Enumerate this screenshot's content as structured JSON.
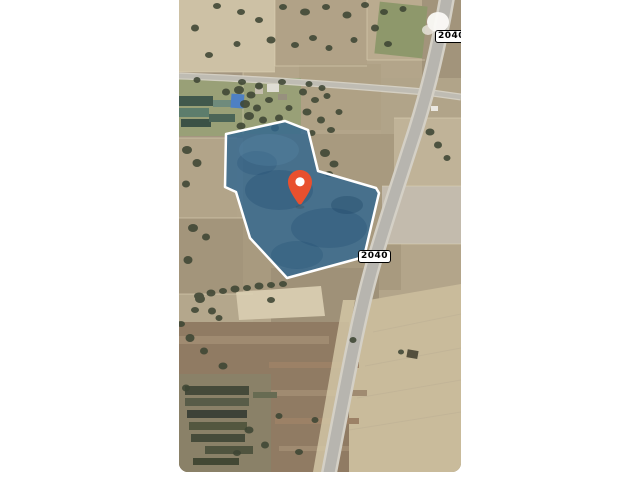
{
  "page": {
    "background_color": "#ffffff"
  },
  "map": {
    "view_type": "satellite",
    "route_shields": [
      {
        "label": "2040"
      },
      {
        "label": "2040"
      }
    ],
    "parcel": {
      "fill": "#2e6590",
      "fill_opacity": "0.8",
      "stroke": "#ffffff",
      "stroke_width": "2.5"
    },
    "marker": {
      "color": "#e8502e",
      "hole_color": "#ffffff"
    }
  }
}
